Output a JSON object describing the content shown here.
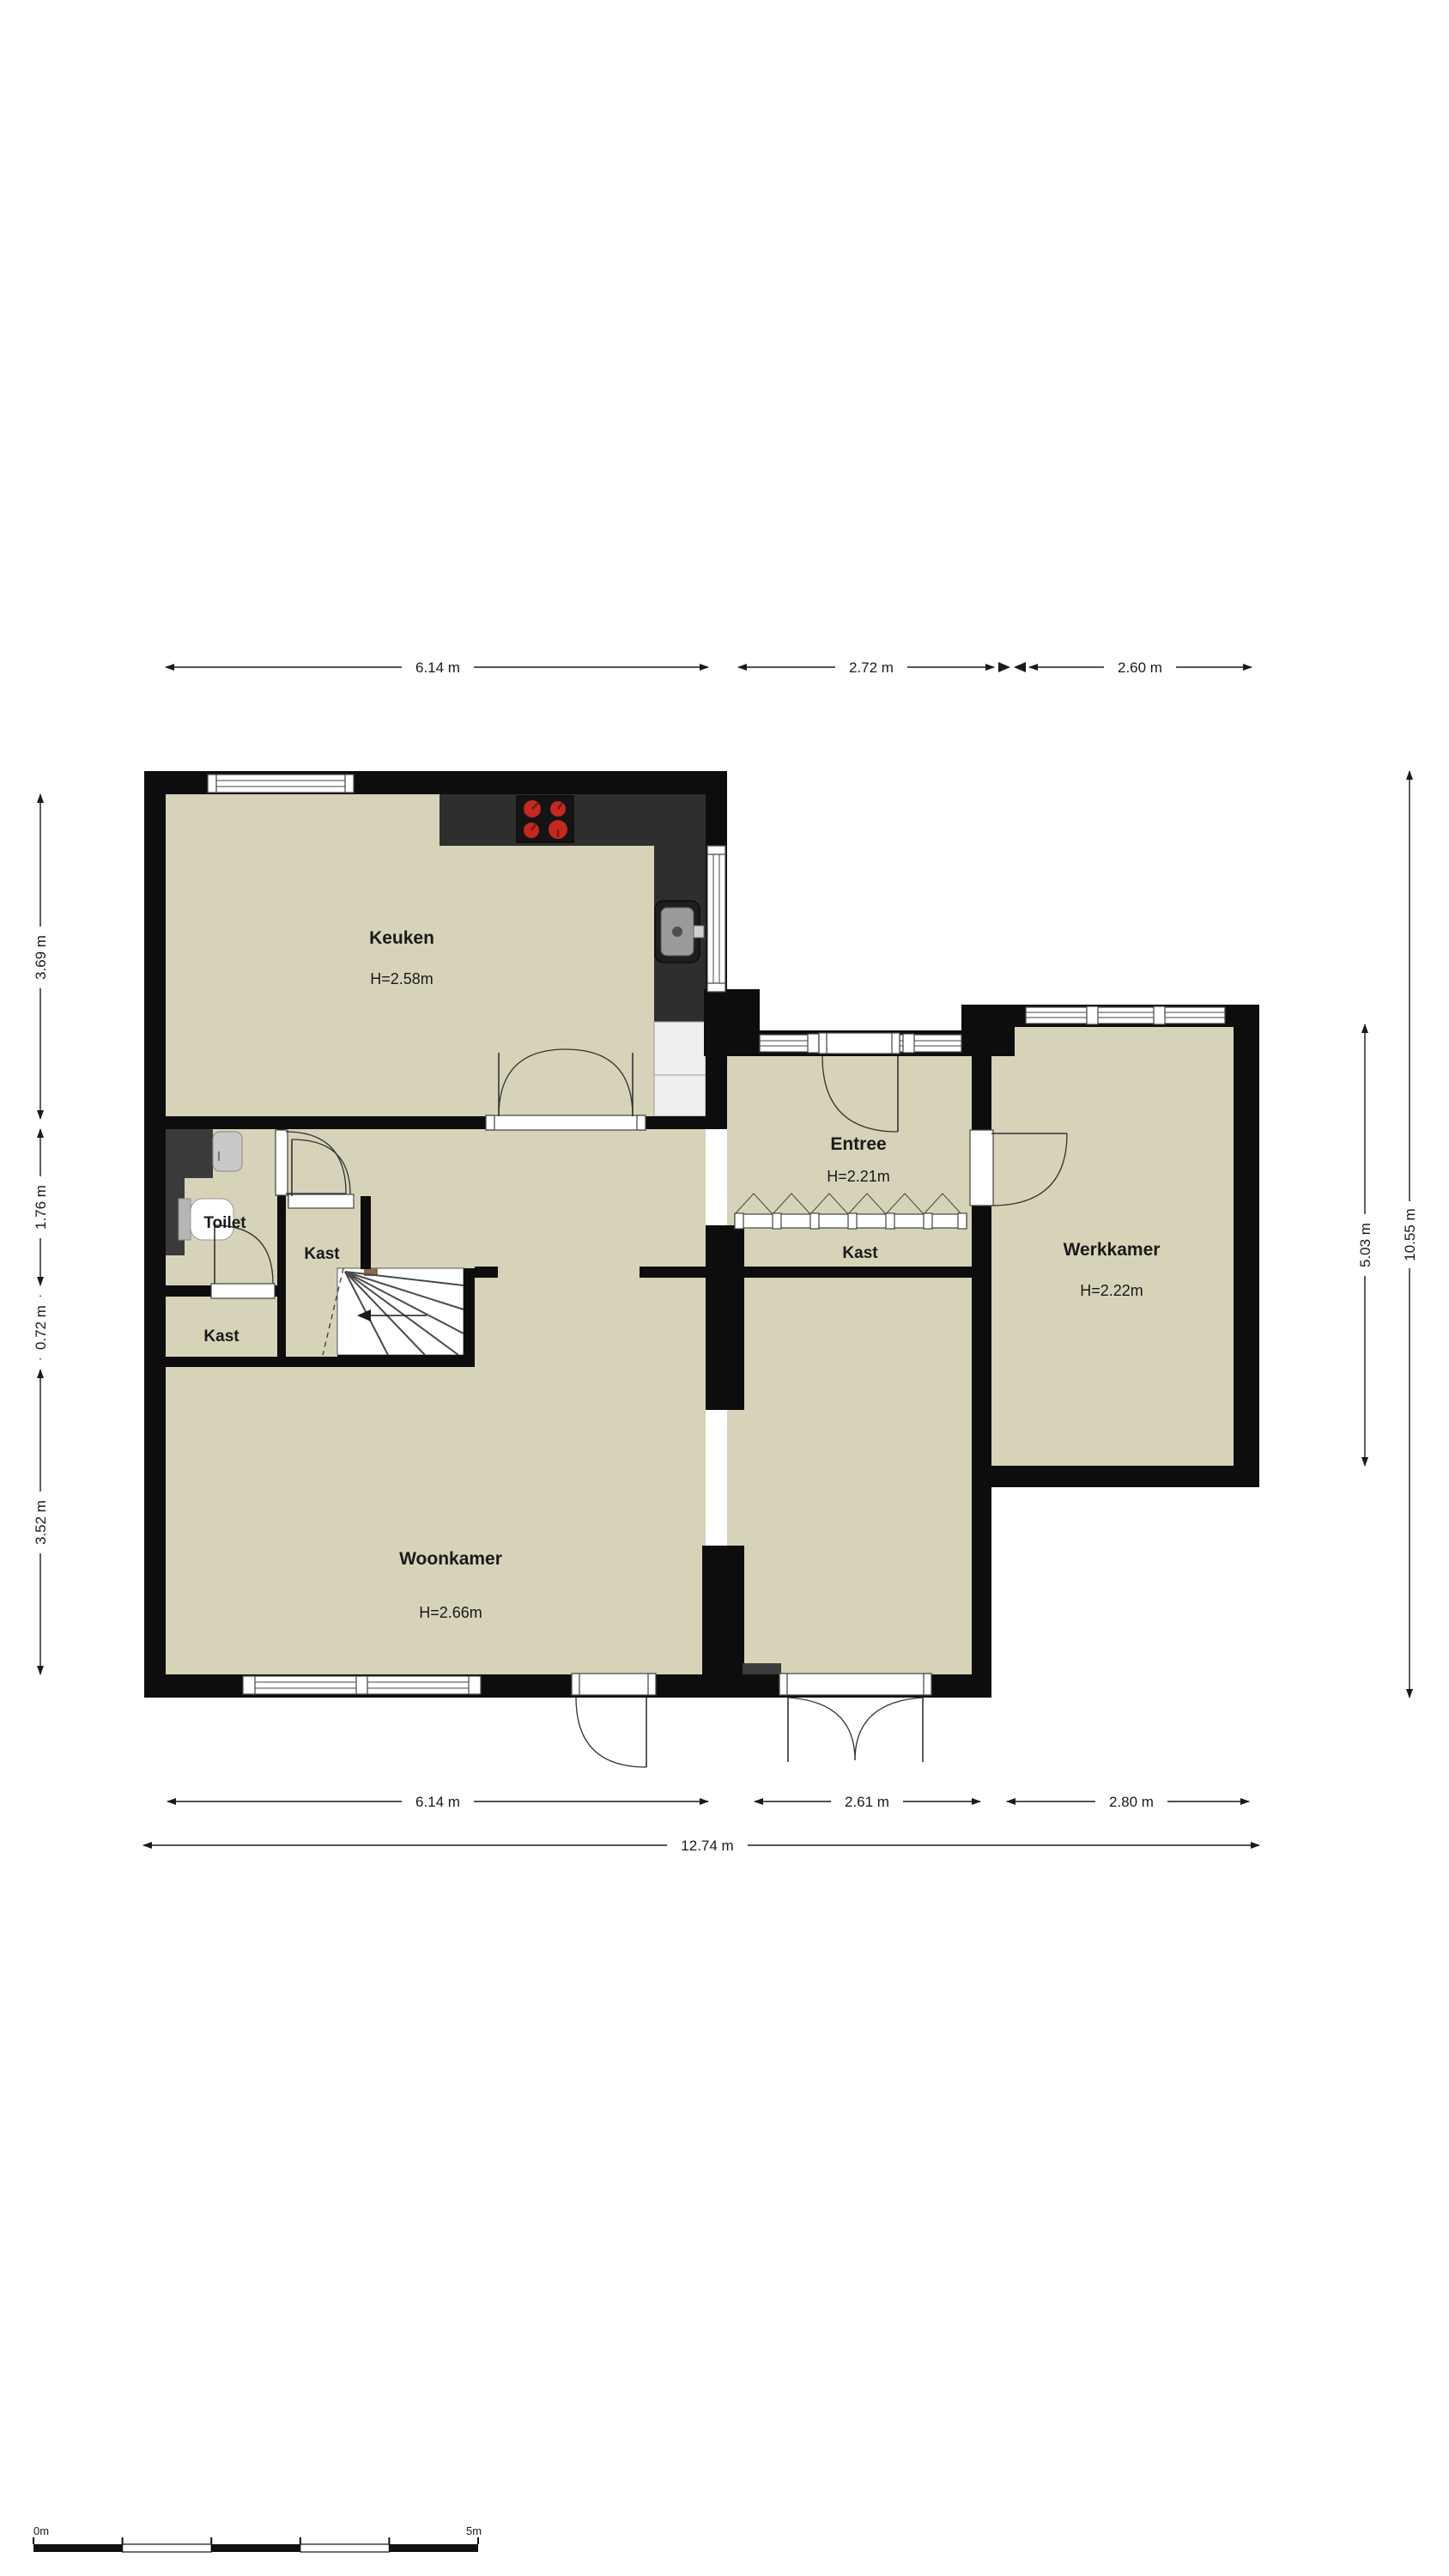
{
  "rooms": {
    "keuken": {
      "name": "Keuken",
      "height": "H=2.58m"
    },
    "entree": {
      "name": "Entree",
      "height": "H=2.21m"
    },
    "werkkamer": {
      "name": "Werkkamer",
      "height": "H=2.22m"
    },
    "woonkamer": {
      "name": "Woonkamer",
      "height": "H=2.66m"
    },
    "toilet": {
      "name": "Toilet"
    },
    "kast_hal": {
      "name": "Kast"
    },
    "kast_entree": {
      "name": "Kast"
    },
    "kast_woonkamer": {
      "name": "Kast"
    }
  },
  "dimensions": {
    "top": [
      "6.14 m",
      "2.72 m",
      "2.60 m"
    ],
    "bottom": [
      "6.14 m",
      "2.61 m",
      "2.80 m"
    ],
    "bottom_total": "12.74 m",
    "left": [
      "3.69 m",
      "1.76 m",
      "0.72 m",
      "3.52 m"
    ],
    "right": [
      "5.03 m",
      "10.55 m"
    ]
  },
  "scale_bar": {
    "start": "0m",
    "end": "5m"
  },
  "colors": {
    "floor": "#d6d3b9",
    "wall": "#0d0d0d",
    "counter": "#2e2e2c",
    "burner": "#c4281f",
    "burner_dark": "#7a1612",
    "appliance": "#efefef",
    "fixture_dark": "#3a3a3a",
    "fixture_light": "#c9c9c9",
    "stair_wood": "#8a6a4a"
  }
}
